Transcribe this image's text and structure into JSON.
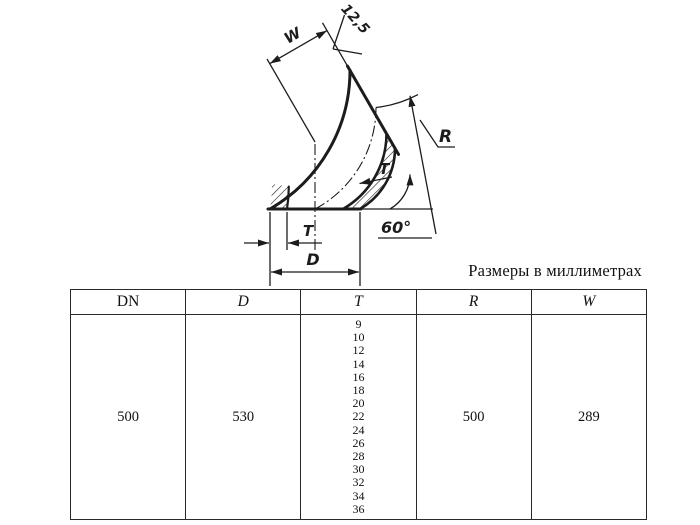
{
  "caption": "Размеры в миллиметрах",
  "diagram": {
    "labels": {
      "w": "W",
      "roughness": "12,5",
      "r": "R",
      "t_wall": "T",
      "angle": "60°",
      "t_dim": "T",
      "d_dim": "D"
    }
  },
  "table": {
    "headers": [
      "DN",
      "D",
      "T",
      "R",
      "W"
    ],
    "row": {
      "dn": "500",
      "d": "530",
      "t_values": [
        "9",
        "10",
        "12",
        "14",
        "16",
        "18",
        "20",
        "22",
        "24",
        "26",
        "28",
        "30",
        "32",
        "34",
        "36"
      ],
      "r": "500",
      "w": "289"
    }
  },
  "colors": {
    "ink": "#1c1c1c"
  }
}
